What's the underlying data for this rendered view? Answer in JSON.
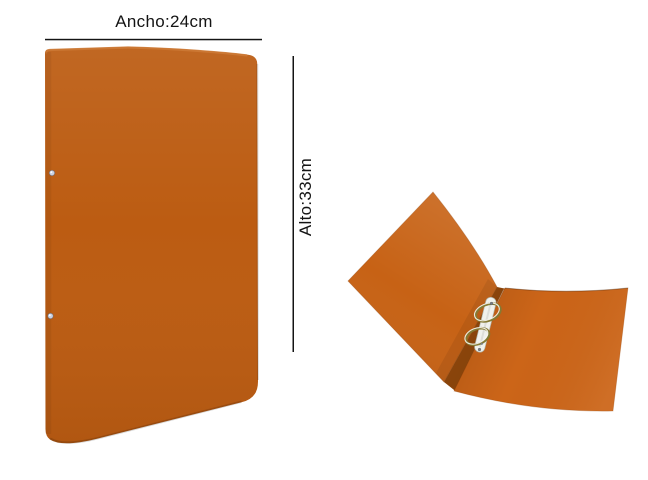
{
  "page": {
    "background_color": "#ffffff"
  },
  "annotations": {
    "width_dimension": {
      "label": "Ancho:24cm"
    },
    "height_dimension": {
      "label": "Alto:33cm"
    },
    "line_color": "#141414",
    "text_color": "#141414"
  },
  "binder": {
    "closed_view": {
      "cover_color": "#bc5c12",
      "edge_highlight_color": "#cd7a36",
      "rivet_color": "#ccd3e3"
    },
    "open_view": {
      "left_cover_color": "#c76215",
      "right_cover_color": "#cc6518",
      "spine_color": "#a3510d",
      "mechanism_plate_color": "#f0f1ec",
      "ring_metal_color": "#857a33",
      "screw_color": "#787e86"
    }
  }
}
